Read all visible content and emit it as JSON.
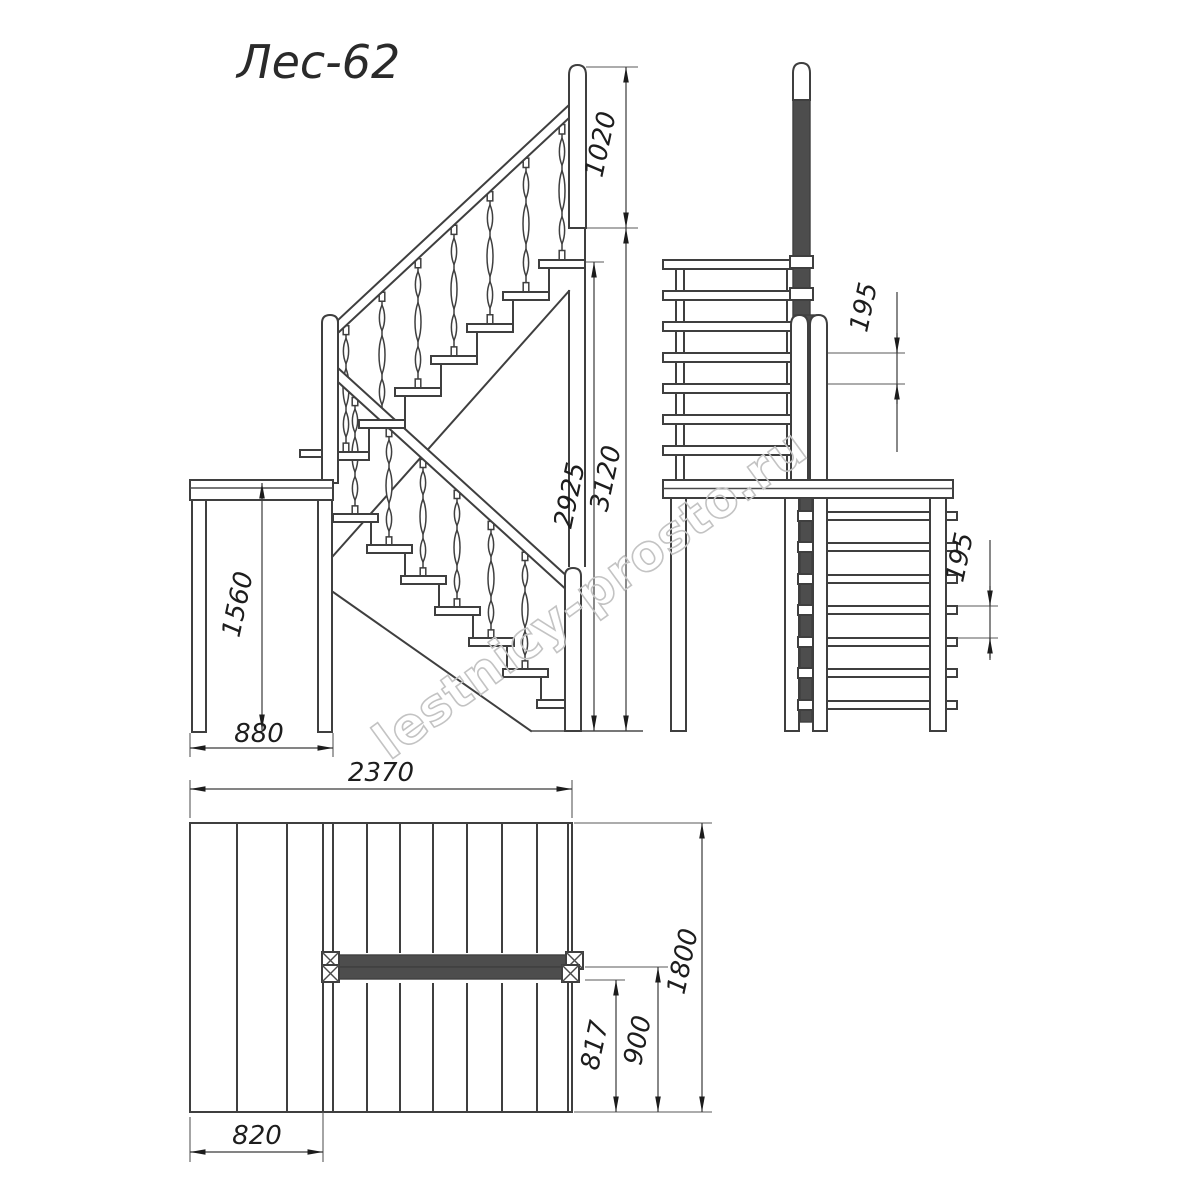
{
  "title": "Лес-62",
  "watermark": "lestnicy-prosto.ru",
  "colors": {
    "line": "#3f3f3f",
    "dark_fill": "#4d4d4d",
    "dim_text": "#1d1d1d",
    "dim_red": "#5e2a1e",
    "watermark": "#c3c3c3",
    "background": "#ffffff"
  },
  "views": {
    "side": {
      "name": "side elevation",
      "dims": {
        "rail_height": "1020",
        "flight_height": "2925",
        "total_height": "3120",
        "landing_height": "1560",
        "landing_depth": "880"
      }
    },
    "front": {
      "name": "front elevation",
      "dims": {
        "upper_step_pitch": "195",
        "lower_step_pitch": "195"
      }
    },
    "plan": {
      "name": "plan view",
      "dims": {
        "total_length": "2370",
        "total_width": "1800",
        "lower_flight_run": "817",
        "flight_width": "900",
        "landing_width": "820"
      }
    }
  }
}
